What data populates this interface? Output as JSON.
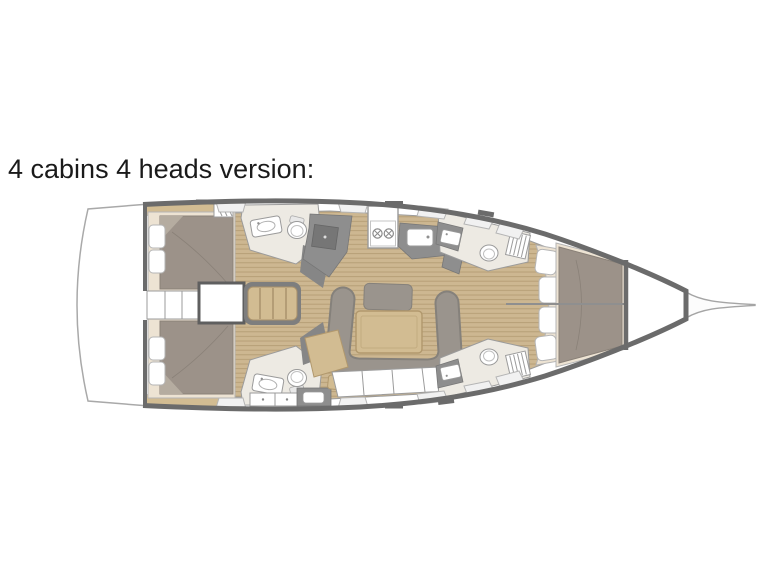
{
  "page": {
    "background": "#ffffff",
    "width": 768,
    "height": 576
  },
  "title": {
    "text": "4 cabins 4 heads version:",
    "color": "#1a1a1a"
  },
  "diagram": {
    "type": "yacht-floor-plan",
    "subject": "sailing yacht interior layout, top view, bow pointing right",
    "cabins": 4,
    "heads": 4,
    "rooms": [
      "aft-cabin-port",
      "aft-cabin-starboard",
      "aft-head-port",
      "aft-head-starboard",
      "engine-compartment",
      "companionway-stairs",
      "galley",
      "salon",
      "nav-station",
      "forward-head-port",
      "forward-head-starboard",
      "forward-cabin",
      "anchor-locker",
      "bowsprit"
    ],
    "colors": {
      "hull_outline": "#6b6b6b",
      "thin_line": "#9b9b9b",
      "deck_white": "#ffffff",
      "teak_floor": "#cdb791",
      "teak_plank_line": "#b49c74",
      "bed_duvet": "#9c9289",
      "bed_duvet_shadow": "#8a8178",
      "mattress_cream": "#ede3d3",
      "cushion_gray": "#9a948d",
      "counter_gray": "#8e8e8e",
      "panel_dark": "#7e7e7e",
      "head_floor": "#edeae3",
      "wood_tan": "#d2bc92",
      "hatch_gray": "#f1f1f1",
      "title_color": "#1a1a1a",
      "page_bg": "#ffffff"
    }
  }
}
